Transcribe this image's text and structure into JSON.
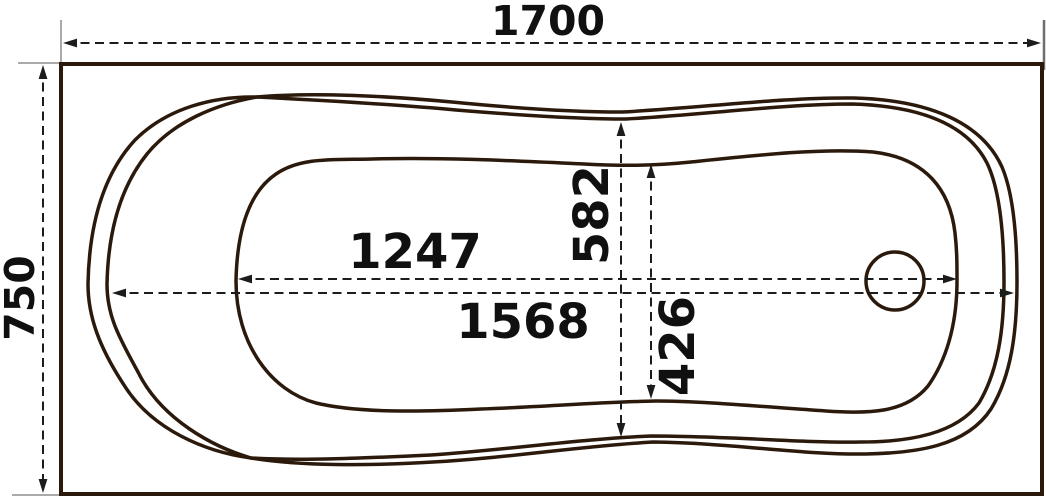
{
  "diagram": {
    "type": "technical-drawing",
    "subject": "bathtub-top-view-with-dimensions",
    "colors": {
      "tub_line": "#2b1a0c",
      "dimension_line": "#1c1c1c",
      "extension_line": "#8d8d8d",
      "text": "#101010",
      "background": "#ffffff"
    },
    "dimensions": {
      "overall_length": "1700",
      "overall_width": "750",
      "basin_length": "1247",
      "rim_length": "1568",
      "rim_width": "582",
      "basin_width": "426"
    }
  }
}
